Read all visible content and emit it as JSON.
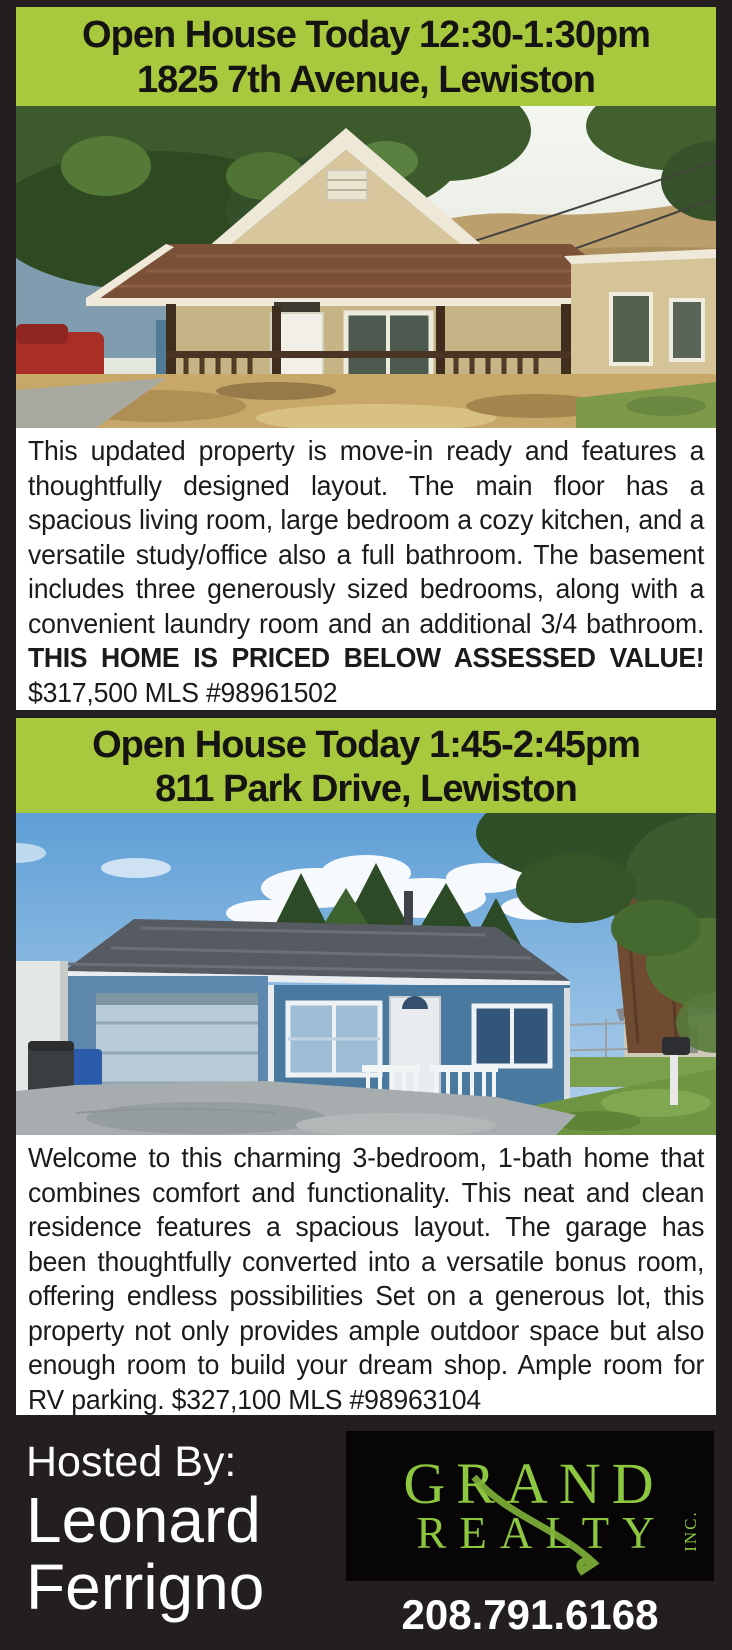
{
  "theme": {
    "page-bg": "#231f20",
    "footer-bg": "#231f20",
    "banner-green": "#a8c93e",
    "logo-green": "#8dc63f",
    "logo-bg": "#070505"
  },
  "listing1": {
    "banner": {
      "line1": "Open House Today 12:30-1:30pm",
      "line2": "1825 7th Avenue, Lewiston"
    },
    "description": {
      "main": "This updated property is move-in ready and features a thoughtfully designed layout. The main floor has a spacious living room, large bedroom a cozy kitchen, and a versatile study/office also a full bathroom. The basement includes three generously sized bedrooms, along with a convenient laundry room and an additional 3/4 bathroom. ",
      "emphasis": "THIS HOME IS PRICED BELOW ASSESSED VALUE!",
      "price_note": " $317,500 MLS #98961502"
    }
  },
  "listing2": {
    "banner": {
      "line1": "Open House Today 1:45-2:45pm",
      "line2": "811 Park Drive, Lewiston"
    },
    "description": {
      "main": "Welcome to this charming 3-bedroom, 1-bath home that combines comfort and functionality. This neat and clean residence features a spacious layout. The garage has been thoughtfully converted into a versatile bonus room, offering endless possibilities Set on a generous lot, this property not only provides ample outdoor space but also enough room to build your dream shop. Ample room for RV parking. $327,100 MLS #98963104"
    }
  },
  "footer": {
    "hosted_by_label": "Hosted By:",
    "agent_name_line1": "Leonard",
    "agent_name_line2": "Ferrigno",
    "phone": "208.791.6168",
    "logo": {
      "line1": "GRAND",
      "line2": "REALTY",
      "suffix": "INC."
    }
  }
}
